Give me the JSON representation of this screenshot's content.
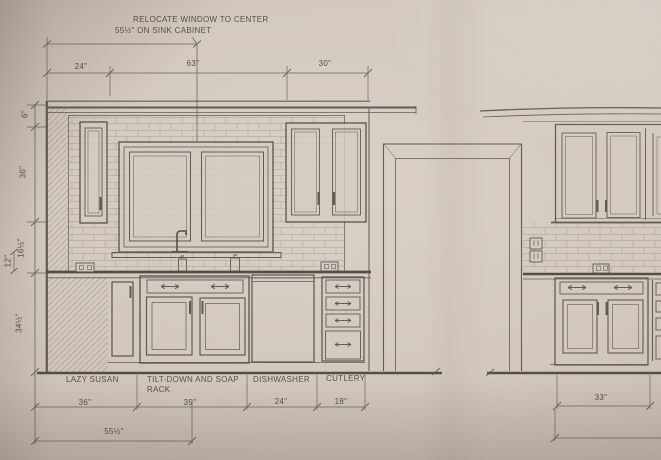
{
  "photo": {
    "paper_color": "#d3c9c0",
    "line_color": "#55504a",
    "text_color": "#4d473f"
  },
  "note": {
    "line1": "RELOCATE WINDOW TO CENTER",
    "line2": "55½\" ON SINK CABINET"
  },
  "dimensions": {
    "top": [
      "24\"",
      "63\"",
      "30\""
    ],
    "left": [
      "6\"",
      "36\"",
      "16½\"",
      "12\"",
      "34½\""
    ],
    "bottom_row1": [
      "36\"",
      "39\"",
      "24\"",
      "18\""
    ],
    "bottom_row2": "55½\"",
    "right_bottom": "33\""
  },
  "labels": {
    "lazy_susan": "LAZY SUSAN",
    "tilt_down_line1": "TILT-DOWN AND SOAP",
    "tilt_down_line2": "RACK",
    "dishwasher": "DISHWASHER",
    "cutlery": "CUTLERY"
  }
}
